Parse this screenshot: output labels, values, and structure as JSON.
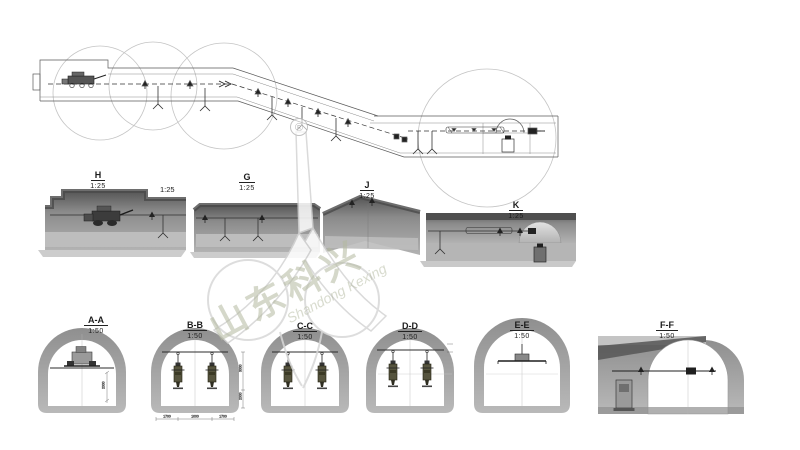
{
  "drawing": {
    "detail_views": [
      {
        "name": "H",
        "scale": "1:25"
      },
      {
        "name": "G",
        "scale": "1:25"
      },
      {
        "name": "J",
        "scale": "1:25"
      },
      {
        "name": "K",
        "scale": "1:25"
      }
    ],
    "h_secondary_scale": "1:25",
    "cross_sections": [
      {
        "name": "A-A",
        "scale": "1:50"
      },
      {
        "name": "B-B",
        "scale": "1:50"
      },
      {
        "name": "C-C",
        "scale": "1:50"
      },
      {
        "name": "D-D",
        "scale": "1:50"
      },
      {
        "name": "E-E",
        "scale": "1:50"
      },
      {
        "name": "F-F",
        "scale": "1:50"
      }
    ],
    "dimensions": {
      "aa_height": "2000",
      "bb_drop": "3000",
      "bb_clearance": "2000",
      "bb_spacing": [
        "1700",
        "1000",
        "1700"
      ]
    }
  },
  "watermark": {
    "registered": "®",
    "cn": "山东科兴",
    "en": "Shandong Kexing"
  },
  "colors": {
    "plan_line": "#5a5a5a",
    "callout_circle": "#c4c4c4",
    "render_dark": "#585858",
    "render_mid": "#9a9a9a",
    "render_light": "#bdbdbd",
    "lining_gray": "#a2a2a2",
    "equipment_olive": "#56543e",
    "watermark_gray_green": "#c9cdbc"
  }
}
